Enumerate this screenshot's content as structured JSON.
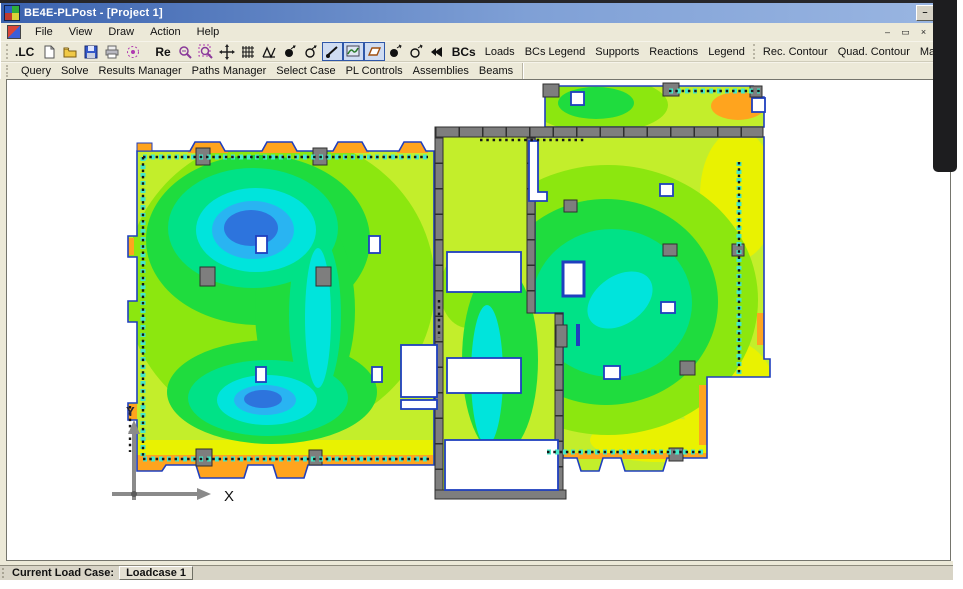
{
  "window": {
    "title": "BE4E-PLPost - [Project 1]"
  },
  "titlebar_buttons": {
    "minimize": "–",
    "restore": "▭"
  },
  "menu": {
    "items": [
      "File",
      "View",
      "Draw",
      "Action",
      "Help"
    ]
  },
  "child_buttons": {
    "minimize": "–",
    "restore": "▭",
    "close": "×"
  },
  "toolbar_main": {
    "lc_label": ".LC",
    "re_label": "Re",
    "bcs_label": "BCs",
    "buttons": [
      "Loads",
      "BCs Legend",
      "Supports",
      "Reactions",
      "Legend",
      "Rec. Contour",
      "Quad. Contour",
      "Max/Min",
      "Draw Strip"
    ]
  },
  "toolbar_secondary": {
    "buttons": [
      "Query",
      "Solve",
      "Results Manager",
      "Paths Manager",
      "Select Case",
      "PL Controls",
      "Assemblies",
      "Beams"
    ]
  },
  "statusbar": {
    "label": "Current Load Case:",
    "value": "Loadcase 1"
  },
  "plot": {
    "type": "FEA slab contour plot",
    "axis_x_label": "X",
    "axis_y_label": "Y"
  },
  "icons": [
    "new",
    "open",
    "save",
    "print",
    "zoom-extents",
    "zoom-out",
    "zoom-window",
    "pan",
    "grid",
    "mesh",
    "node",
    "node-outline",
    "strip-toggle",
    "contour-toggle",
    "patch-toggle",
    "load",
    "load-outline",
    "loads-arrows"
  ],
  "palette": {
    "base": "#c3ee2b",
    "yellow": "#e9f201",
    "lightgreen": "#8ce70f",
    "green": "#1fdc3e",
    "spring": "#00e287",
    "cyan": "#00e4dc",
    "sky": "#29b4f2",
    "blue": "#2d74dd",
    "orange": "#ffa41e",
    "outline": "#1f3fbf",
    "wall": "#7e7e7e",
    "wallDark": "#2f2f2f",
    "dotCyan": "#45e8c8",
    "dotBlack": "#161616",
    "axis": "#8a8a8a",
    "titlebar": "#3a62ae",
    "toolbar_bg": "#ece9d8"
  }
}
